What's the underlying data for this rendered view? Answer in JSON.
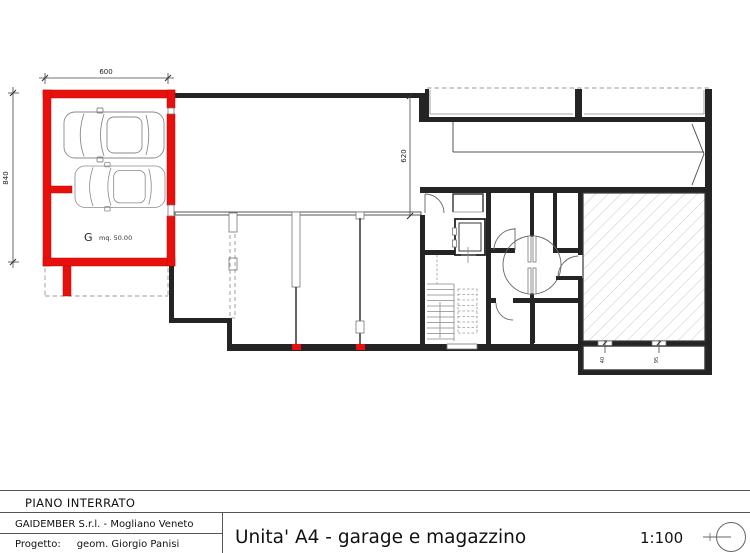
{
  "colors": {
    "red": "#e8100c",
    "wall": "#242424"
  },
  "plan": {
    "garage_label": "G",
    "garage_area": "mq. 50.00",
    "dim_width": "600",
    "dim_height": "840",
    "dim_court": "620",
    "dim_small_1": "40",
    "dim_small_2": "95"
  },
  "title_block": {
    "floor": "PIANO INTERRATO",
    "company": "GAIDEMBER S.r.l. - Mogliano Veneto",
    "project_label": "Progetto:",
    "project_author": "geom. Giorgio Panisi",
    "drawing_title": "Unita' A4 - garage e magazzino",
    "scale": "1:100"
  }
}
